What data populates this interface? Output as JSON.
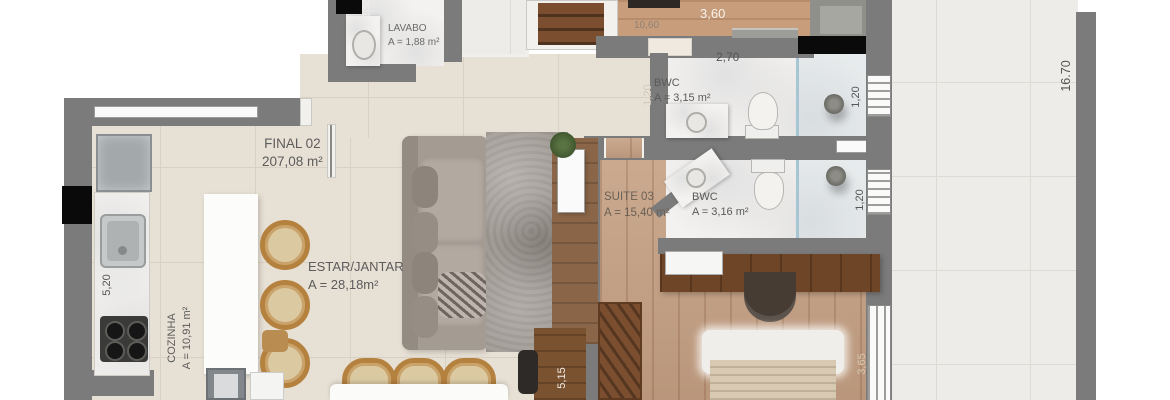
{
  "unit": {
    "name": "FINAL 02",
    "total_area": "207,08 m²"
  },
  "rooms": {
    "lavabo": {
      "name": "LAVABO",
      "area": "A = 1,88 m²"
    },
    "bwc1": {
      "name": "BWC",
      "area": "A = 3,15 m²"
    },
    "bwc2": {
      "name": "BWC",
      "area": "A = 3,16 m²"
    },
    "suite03": {
      "name": "SUITE 03",
      "area": "A = 15,40 m²"
    },
    "estar": {
      "name": "ESTAR/JANTAR",
      "area": "A = 28,18m²"
    },
    "cozinha": {
      "name": "COZINHA",
      "area": "A = 10,91 m²"
    }
  },
  "dimensions": {
    "d150": "1,50",
    "d1060": "10,60",
    "d360": "3,60",
    "d270": "2,70",
    "d120_hall": "1,20",
    "d120_bwc1": "1,20",
    "d120_bwc2": "1,20",
    "d520": "5,20",
    "d515": "5,15",
    "d365": "3,65",
    "d1670": "16.70"
  },
  "colors": {
    "wall_gray": "#7b7b7b",
    "floor_tile_beige": "#e7e0d4",
    "floor_wood": "#c5a083",
    "terrace_tile": "#edece8",
    "bathroom_marble": "#f3f2f0",
    "furniture_dark_wood": "#7a4e2e",
    "door_marker_black": "#0a0a0a"
  }
}
